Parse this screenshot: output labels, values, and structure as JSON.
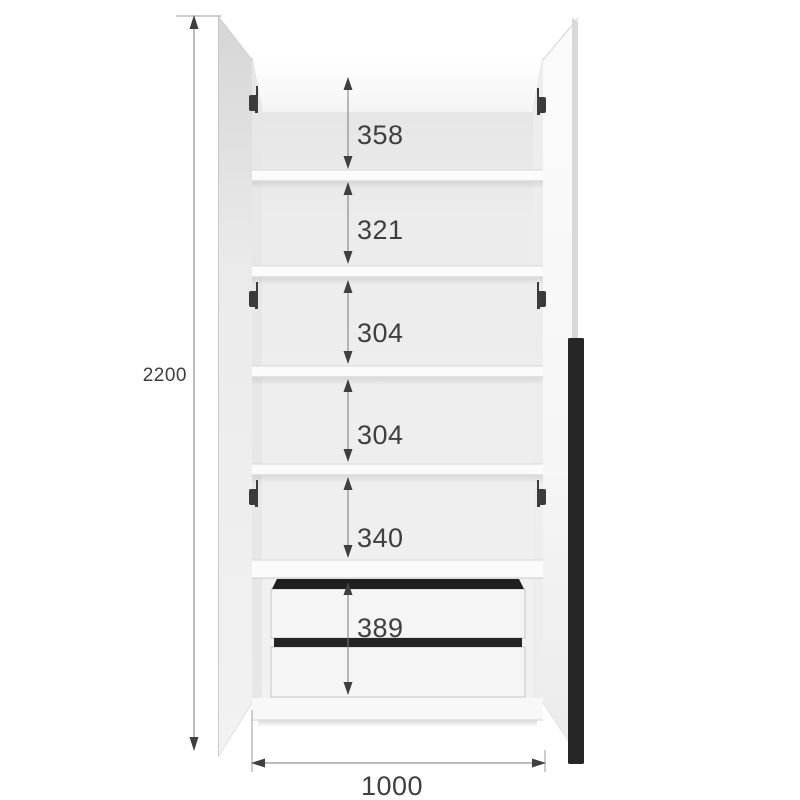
{
  "diagram": {
    "type": "furniture-dimension-drawing",
    "subject": "two-door wardrobe with open doors, interior shelves and two drawers",
    "overall": {
      "height_mm": "2200",
      "width_mm": "1000"
    },
    "sections_top_to_bottom": [
      {
        "label": "358"
      },
      {
        "label": "321"
      },
      {
        "label": "304"
      },
      {
        "label": "304"
      },
      {
        "label": "340"
      },
      {
        "label": "389"
      }
    ],
    "features": {
      "shelf_count": 5,
      "drawer_count": 2,
      "door_count": 2,
      "hinge_pairs": 3,
      "handle_style": "vertical-bar"
    },
    "colors": {
      "background": "#ffffff",
      "handle": "#262626",
      "drawer_gap": "#1f1f1f",
      "dimension_line": "#787878",
      "extension_line": "#9b9b9b",
      "dimension_text": "#3f3f3f",
      "cabinet_surface": "#f2f2f2"
    }
  }
}
